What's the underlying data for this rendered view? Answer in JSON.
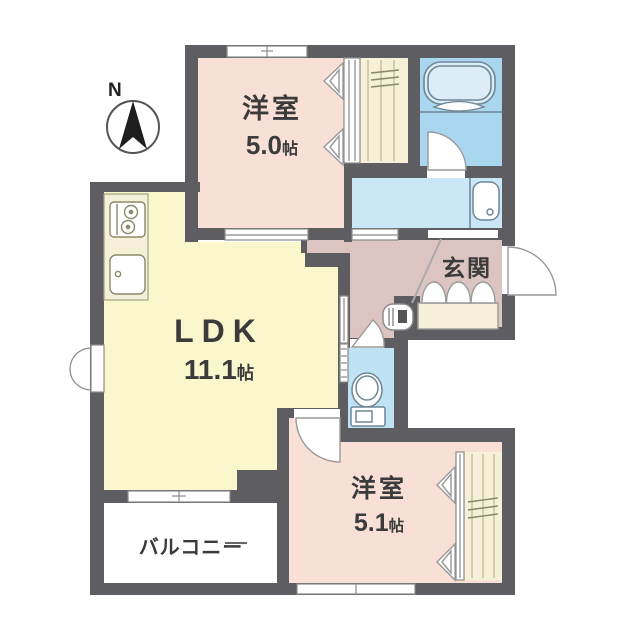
{
  "floor_plan": {
    "compass_label": "N",
    "rooms": {
      "bedroom_top": {
        "name": "洋室",
        "area_value": "5.0",
        "area_unit": "帖"
      },
      "ldk": {
        "name": "LDK",
        "area_value": "11.1",
        "area_unit": "帖"
      },
      "bedroom_bottom": {
        "name": "洋室",
        "area_value": "5.1",
        "area_unit": "帖"
      },
      "entrance": {
        "name": "玄関"
      },
      "balcony": {
        "name": "バルコニー"
      }
    },
    "colors": {
      "wall": "#5e5e62",
      "bedroom_floor": "#f8e0d7",
      "ldk_floor": "#fbf7cd",
      "hallway_floor": "#dcc5c1",
      "bathroom_floor": "#a9d7ef",
      "washroom_floor": "#c9e7f7",
      "toilet_floor": "#bfe2f5",
      "closet_floor": "#f6f0d8",
      "balcony_floor": "#ffffff",
      "fixture_line": "#7f93a0",
      "kitchen_line": "#90906e",
      "door_line": "#999999"
    }
  }
}
